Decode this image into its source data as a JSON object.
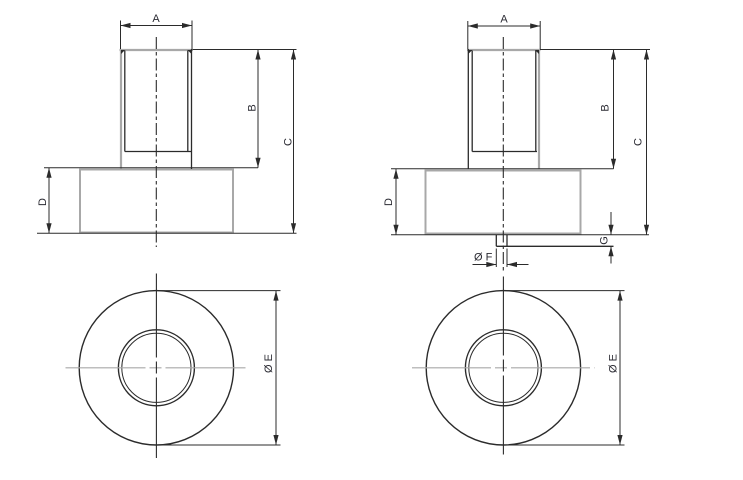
{
  "views": {
    "side_left": {
      "dim_a": "A",
      "dim_b": "B",
      "dim_c": "C",
      "dim_d": "D"
    },
    "side_right": {
      "dim_a": "A",
      "dim_b": "B",
      "dim_c": "C",
      "dim_d": "D",
      "dim_g": "G",
      "dim_f": "Ø F"
    },
    "top_left": {
      "dim_e": "Ø E"
    },
    "top_right": {
      "dim_e": "Ø E"
    }
  },
  "colors": {
    "outline_gray": "#a8a8a8",
    "line_dark": "#2b2b2b",
    "label_text": "#2b2b33",
    "background": "#ffffff"
  }
}
